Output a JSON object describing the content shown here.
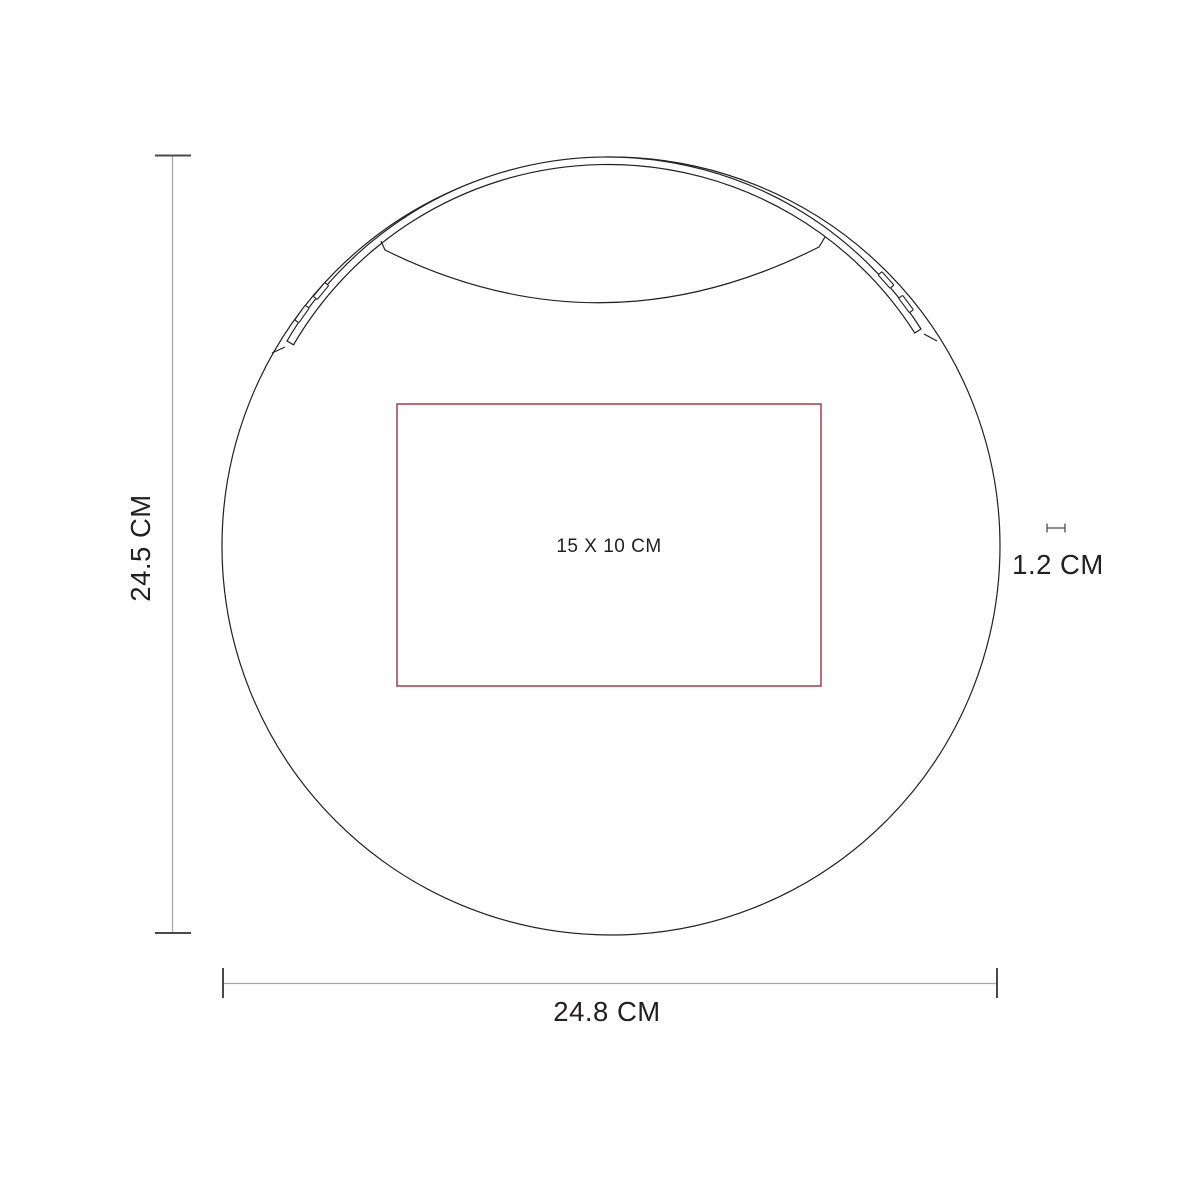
{
  "diagram": {
    "type": "product-dimension-line-art",
    "product": "round-case-with-strap",
    "print_area": {
      "label": "15 X 10 CM"
    },
    "dimensions": {
      "height_label": "24.5 CM",
      "width_label": "24.8 CM",
      "depth_label": "1.2 CM"
    },
    "colors": {
      "artwork_line": "#231f20",
      "dimension_line": "#a7a9ac",
      "dimension_tick": "#4a4a4c",
      "print_area_red": "#993140",
      "background": "#ffffff",
      "text": "#231f20"
    }
  }
}
